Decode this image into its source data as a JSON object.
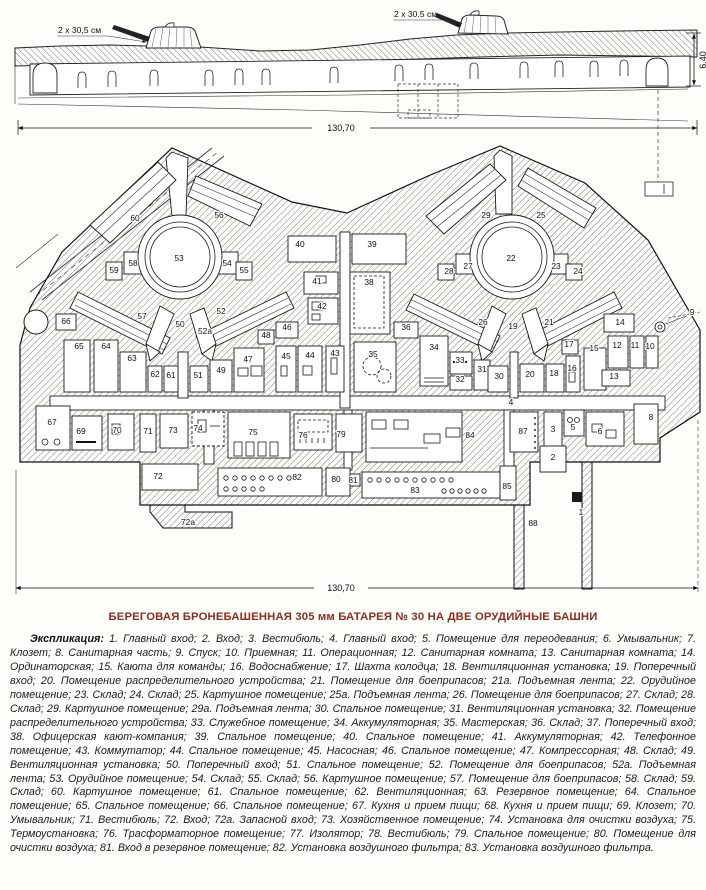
{
  "title": "БЕРЕГОВАЯ БРОНЕБАШЕННАЯ 305 мм БАТАРЕЯ № 30 НА ДВЕ ОРУДИЙНЫЕ БАШНИ",
  "section": {
    "left_gun_label": "2 х 30,5 см",
    "right_gun_label": "2 х 30.5 см",
    "length_dim": "130,70",
    "height_dim": "6,40"
  },
  "plan": {
    "length_dim": "130,70",
    "room_labels": [
      {
        "n": "60",
        "x": 135,
        "y": 221
      },
      {
        "n": "56",
        "x": 219,
        "y": 218
      },
      {
        "n": "53",
        "x": 179,
        "y": 261,
        "s": 10
      },
      {
        "n": "58",
        "x": 133,
        "y": 266
      },
      {
        "n": "59",
        "x": 114,
        "y": 273
      },
      {
        "n": "54",
        "x": 227,
        "y": 266
      },
      {
        "n": "55",
        "x": 244,
        "y": 273
      },
      {
        "n": "57",
        "x": 142,
        "y": 319
      },
      {
        "n": "52",
        "x": 221,
        "y": 314
      },
      {
        "n": "50",
        "x": 180,
        "y": 327
      },
      {
        "n": "52а",
        "x": 205,
        "y": 334
      },
      {
        "n": "66",
        "x": 66,
        "y": 324
      },
      {
        "n": "65",
        "x": 79,
        "y": 349
      },
      {
        "n": "64",
        "x": 106,
        "y": 349
      },
      {
        "n": "63",
        "x": 132,
        "y": 361
      },
      {
        "n": "62",
        "x": 155,
        "y": 377
      },
      {
        "n": "61",
        "x": 171,
        "y": 378
      },
      {
        "n": "51",
        "x": 198,
        "y": 378
      },
      {
        "n": "49",
        "x": 221,
        "y": 373
      },
      {
        "n": "47",
        "x": 248,
        "y": 362
      },
      {
        "n": "48",
        "x": 266,
        "y": 338
      },
      {
        "n": "46",
        "x": 287,
        "y": 330
      },
      {
        "n": "45",
        "x": 286,
        "y": 359
      },
      {
        "n": "44",
        "x": 310,
        "y": 358
      },
      {
        "n": "43",
        "x": 335,
        "y": 356
      },
      {
        "n": "40",
        "x": 300,
        "y": 247
      },
      {
        "n": "41",
        "x": 317,
        "y": 284
      },
      {
        "n": "42",
        "x": 322,
        "y": 309
      },
      {
        "n": "39",
        "x": 372,
        "y": 247
      },
      {
        "n": "38",
        "x": 369,
        "y": 285
      },
      {
        "n": "36",
        "x": 406,
        "y": 330
      },
      {
        "n": "35",
        "x": 373,
        "y": 357
      },
      {
        "n": "34",
        "x": 434,
        "y": 350
      },
      {
        "n": "33",
        "x": 460,
        "y": 363
      },
      {
        "n": "32",
        "x": 460,
        "y": 382
      },
      {
        "n": "31",
        "x": 482,
        "y": 372
      },
      {
        "n": "30",
        "x": 499,
        "y": 379
      },
      {
        "n": "29",
        "x": 486,
        "y": 218
      },
      {
        "n": "25",
        "x": 541,
        "y": 218
      },
      {
        "n": "22",
        "x": 511,
        "y": 261,
        "s": 10
      },
      {
        "n": "27",
        "x": 468,
        "y": 269
      },
      {
        "n": "28",
        "x": 449,
        "y": 274
      },
      {
        "n": "23",
        "x": 556,
        "y": 269
      },
      {
        "n": "24",
        "x": 578,
        "y": 274
      },
      {
        "n": "26",
        "x": 483,
        "y": 325
      },
      {
        "n": "21",
        "x": 549,
        "y": 325
      },
      {
        "n": "19",
        "x": 513,
        "y": 329
      },
      {
        "n": "20",
        "x": 530,
        "y": 377
      },
      {
        "n": "18",
        "x": 554,
        "y": 376
      },
      {
        "n": "16",
        "x": 572,
        "y": 371
      },
      {
        "n": "17",
        "x": 569,
        "y": 347
      },
      {
        "n": "15",
        "x": 594,
        "y": 351
      },
      {
        "n": "14",
        "x": 620,
        "y": 325
      },
      {
        "n": "12",
        "x": 617,
        "y": 348
      },
      {
        "n": "11",
        "x": 635,
        "y": 348
      },
      {
        "n": "10",
        "x": 650,
        "y": 349
      },
      {
        "n": "13",
        "x": 614,
        "y": 379
      },
      {
        "n": "9",
        "x": 692,
        "y": 315
      },
      {
        "n": "67",
        "x": 52,
        "y": 425
      },
      {
        "n": "69",
        "x": 81,
        "y": 434
      },
      {
        "n": "70",
        "x": 117,
        "y": 433
      },
      {
        "n": "71",
        "x": 148,
        "y": 434
      },
      {
        "n": "73",
        "x": 173,
        "y": 433
      },
      {
        "n": "74",
        "x": 198,
        "y": 431
      },
      {
        "n": "75",
        "x": 253,
        "y": 435
      },
      {
        "n": "76",
        "x": 303,
        "y": 438
      },
      {
        "n": "79",
        "x": 341,
        "y": 437
      },
      {
        "n": "84",
        "x": 470,
        "y": 438
      },
      {
        "n": "87",
        "x": 523,
        "y": 434
      },
      {
        "n": "3",
        "x": 553,
        "y": 432
      },
      {
        "n": "5",
        "x": 573,
        "y": 430
      },
      {
        "n": "6",
        "x": 600,
        "y": 434
      },
      {
        "n": "8",
        "x": 651,
        "y": 420
      },
      {
        "n": "4",
        "x": 511,
        "y": 405
      },
      {
        "n": "2",
        "x": 553,
        "y": 460
      },
      {
        "n": "72",
        "x": 158,
        "y": 479
      },
      {
        "n": "72а",
        "x": 188,
        "y": 525
      },
      {
        "n": "82",
        "x": 297,
        "y": 480
      },
      {
        "n": "80",
        "x": 336,
        "y": 482
      },
      {
        "n": "81",
        "x": 353,
        "y": 483,
        "s": 6.5
      },
      {
        "n": "83",
        "x": 415,
        "y": 493
      },
      {
        "n": "85",
        "x": 507,
        "y": 489
      },
      {
        "n": "88",
        "x": 533,
        "y": 526
      },
      {
        "n": "1",
        "x": 581,
        "y": 515
      }
    ]
  },
  "legend": {
    "lead": "Экспликация:",
    "entries": [
      [
        "1",
        "Главный вход"
      ],
      [
        "2",
        "Вход"
      ],
      [
        "3",
        "Вестибюль"
      ],
      [
        "4",
        "Главный вход"
      ],
      [
        "5",
        "Помещение для переодевания"
      ],
      [
        "6",
        "Умывальник"
      ],
      [
        "7",
        "Клозет"
      ],
      [
        "8",
        "Санитарная часть"
      ],
      [
        "9",
        "Спуск"
      ],
      [
        "10",
        "Приемная"
      ],
      [
        "11",
        "Операционная"
      ],
      [
        "12",
        "Санитарная комната"
      ],
      [
        "13",
        "Санитарная комната"
      ],
      [
        "14",
        "Ординаторская"
      ],
      [
        "15",
        "Каюта для команды"
      ],
      [
        "16",
        "Водоснабжение"
      ],
      [
        "17",
        "Шахта колодца"
      ],
      [
        "18",
        "Вентиляционная установка"
      ],
      [
        "19",
        "Поперечный вход"
      ],
      [
        "20",
        "Помещение распределительного устройства"
      ],
      [
        "21",
        "Помещение для боеприпасов"
      ],
      [
        "21а",
        "Подъемная лента"
      ],
      [
        "22",
        "Орудийное помещение"
      ],
      [
        "23",
        "Склад"
      ],
      [
        "24",
        "Склад"
      ],
      [
        "25",
        "Картушное помещение"
      ],
      [
        "25а",
        "Подъемная лента"
      ],
      [
        "26",
        "Помещение для боеприпасов"
      ],
      [
        "27",
        "Склад"
      ],
      [
        "28",
        "Склад"
      ],
      [
        "29",
        "Картушное помещение"
      ],
      [
        "29а",
        "Подъемная лента"
      ],
      [
        "30",
        "Спальное помещение"
      ],
      [
        "31",
        "Вентиляционная установка"
      ],
      [
        "32",
        "Помещение распределительного устройства"
      ],
      [
        "33",
        "Служебное помещение"
      ],
      [
        "34",
        "Аккумуляторная"
      ],
      [
        "35",
        "Мастерская"
      ],
      [
        "36",
        "Склад"
      ],
      [
        "37",
        "Поперечный вход"
      ],
      [
        "38",
        "Офицерская кают-компания"
      ],
      [
        "39",
        "Спальное помещение"
      ],
      [
        "40",
        "Спальное помещение"
      ],
      [
        "41",
        "Аккумуляторная"
      ],
      [
        "42",
        "Телефонное помещение"
      ],
      [
        "43",
        "Коммутатор"
      ],
      [
        "44",
        "Спальное помещение"
      ],
      [
        "45",
        "Насосная"
      ],
      [
        "46",
        "Спальное помещение"
      ],
      [
        "47",
        "Компрессорная"
      ],
      [
        "48",
        "Склад"
      ],
      [
        "49",
        "Вентиляционная установка"
      ],
      [
        "50",
        "Поперечный вход"
      ],
      [
        "51",
        "Спальное помещение"
      ],
      [
        "52",
        "Помещение для боеприпасов"
      ],
      [
        "52а",
        "Подъемная лента"
      ],
      [
        "53",
        "Орудийное помещение"
      ],
      [
        "54",
        "Склад"
      ],
      [
        "55",
        "Склад"
      ],
      [
        "56",
        "Картушное помещение"
      ],
      [
        "57",
        "Помещение для боеприпасов"
      ],
      [
        "58",
        "Склад"
      ],
      [
        "59",
        "Склад"
      ],
      [
        "60",
        "Картушное помещение"
      ],
      [
        "61",
        "Спальное помещение"
      ],
      [
        "62",
        "Вентиляционная"
      ],
      [
        "63",
        "Резервное помещение"
      ],
      [
        "64",
        "Спальное помещение"
      ],
      [
        "65",
        "Спальное помещение"
      ],
      [
        "66",
        "Спальное помещение"
      ],
      [
        "67",
        "Кухня и прием пищи"
      ],
      [
        "68",
        "Кухня и прием пищи"
      ],
      [
        "69",
        "Клозет"
      ],
      [
        "70",
        "Умывальник"
      ],
      [
        "71",
        "Вестибюль"
      ],
      [
        "72",
        "Вход"
      ],
      [
        "72а",
        "Запасной вход"
      ],
      [
        "73",
        "Хозяйственное помещение"
      ],
      [
        "74",
        "Установка для очистки воздуха"
      ],
      [
        "75",
        "Термоустановка"
      ],
      [
        "76",
        "Трасформаторное помещение"
      ],
      [
        "77",
        "Изолятор"
      ],
      [
        "78",
        "Вестибюль"
      ],
      [
        "79",
        "Спальное помещение"
      ],
      [
        "80",
        "Помещение для очистки воздуха"
      ],
      [
        "81",
        "Вход в резервное помещение"
      ],
      [
        "82",
        "Установка воздушного фильтра"
      ],
      [
        "83",
        "Установка воздушного фильтра"
      ]
    ]
  }
}
